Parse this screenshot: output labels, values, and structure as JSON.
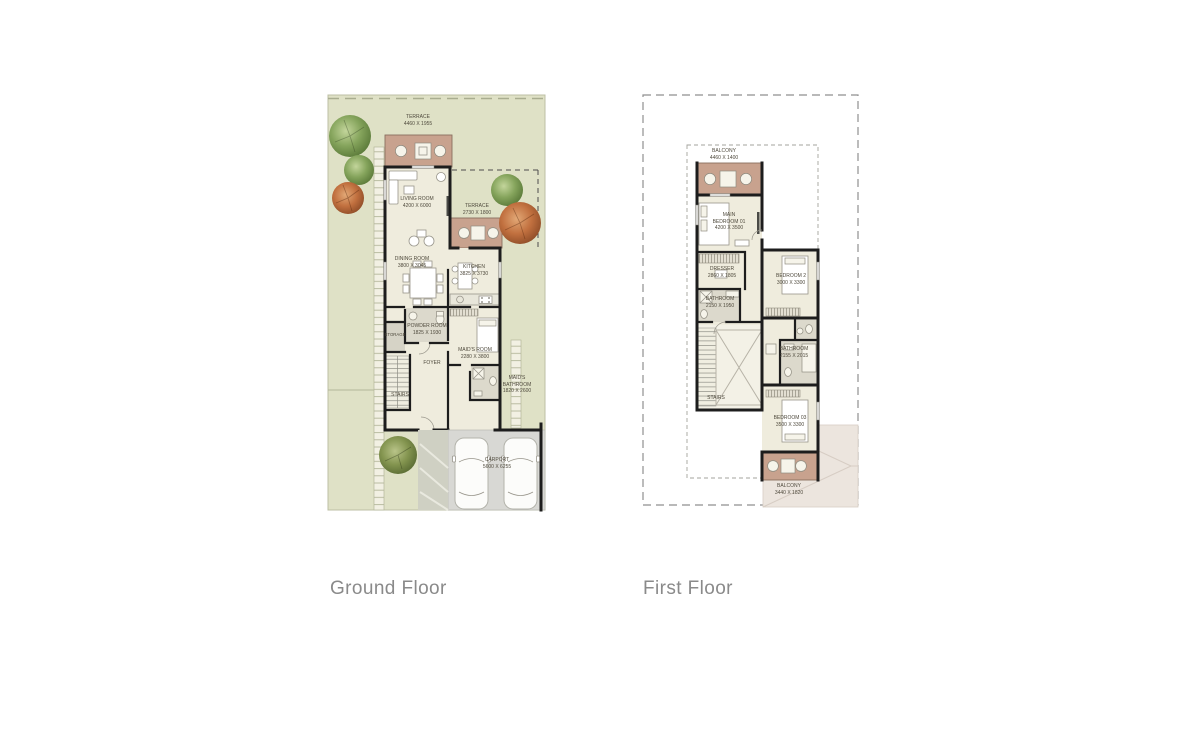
{
  "sheet": {
    "background": "#ffffff"
  },
  "colors": {
    "plot_green": "#dfe1c6",
    "terrace_tan": "#c8a28e",
    "room_cream": "#efecdd",
    "bath_gray": "#dcd9cc",
    "wall_black": "#1d1d1d",
    "carport_gray": "#d8d8d4",
    "roof_light": "#ece5de",
    "caption_gray": "#8a8a8a",
    "tree_green": "#85a45c",
    "tree_orange": "#c1703f"
  },
  "plans": [
    {
      "caption": "Ground Floor",
      "rooms": [
        {
          "name": "TERRACE",
          "dims": "4460 X 1955"
        },
        {
          "name": "LIVING ROOM",
          "dims": "4200 X 6000"
        },
        {
          "name": "TERRACE",
          "dims": "2730 X 1800"
        },
        {
          "name": "DINING ROOM",
          "dims": "3800 X 3045"
        },
        {
          "name": "KITCHEN",
          "dims": "3825 X 3730"
        },
        {
          "name": "POWDER ROOM",
          "dims": "1825 X 1930"
        },
        {
          "name": "STORAGE"
        },
        {
          "name": "MAID'S ROOM",
          "dims": "2280 X 3800"
        },
        {
          "name": "FOYER"
        },
        {
          "name": "STAIRS"
        },
        {
          "name": "MAID'S BATHROOM",
          "dims": "1820 X 2600"
        },
        {
          "name": "CARPORT",
          "dims": "5600 X 6255"
        }
      ]
    },
    {
      "caption": "First Floor",
      "rooms": [
        {
          "name": "BALCONY",
          "dims": "4460 X 1400"
        },
        {
          "name": "MAIN BEDROOM 01",
          "dims": "4200 X 3500"
        },
        {
          "name": "DRESSER",
          "dims": "2860 X 1805"
        },
        {
          "name": "BATHROOM",
          "dims": "2150 X 1950"
        },
        {
          "name": "BEDROOM 2",
          "dims": "3000 X 3300"
        },
        {
          "name": "STAIRS"
        },
        {
          "name": "BATHROOM",
          "dims": "2155 X 2015"
        },
        {
          "name": "BEDROOM 03",
          "dims": "3500 X 3300"
        },
        {
          "name": "BALCONY",
          "dims": "3440 X 1820"
        }
      ]
    }
  ]
}
